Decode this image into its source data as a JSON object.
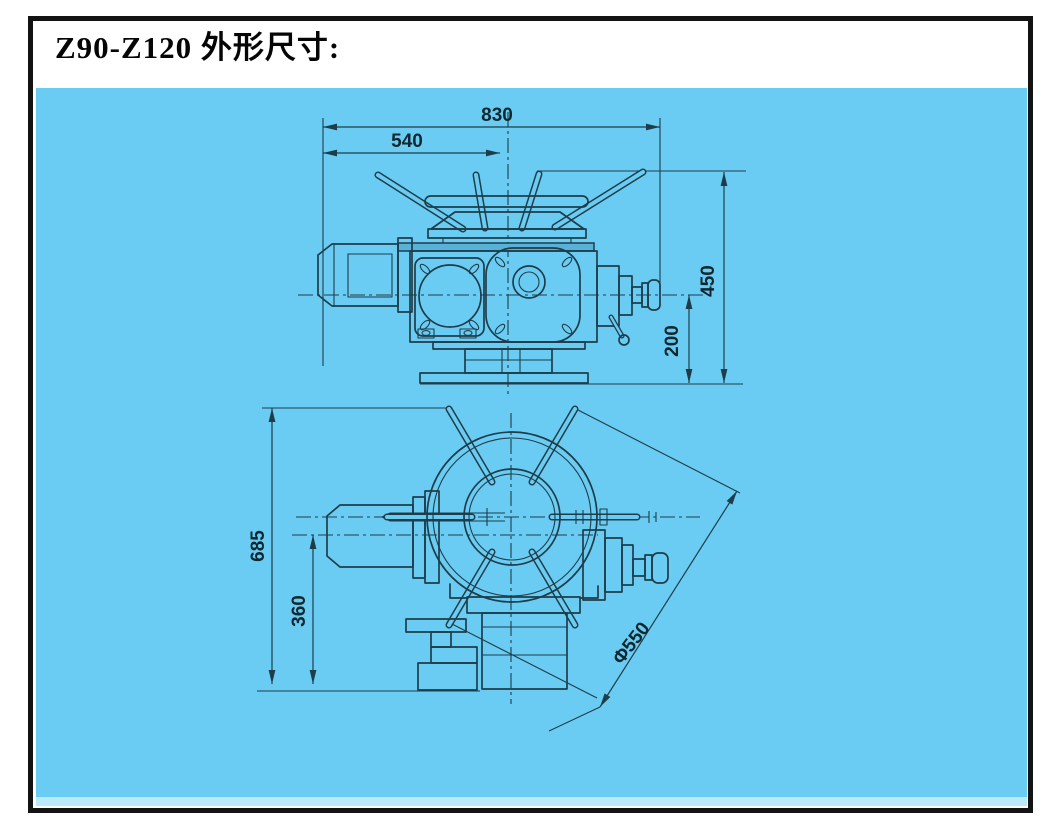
{
  "title": "Z90-Z120 外形尺寸:",
  "colors": {
    "panel_blue": "#6accf2",
    "panel_edge": "#bce9fa",
    "line": "#1e3d4a",
    "text": "#0f2830",
    "frame": "#131313",
    "shade": "#58b2d8"
  },
  "front_view": {
    "dims": {
      "total_width": "830",
      "width_to_axis": "540",
      "total_height": "450",
      "axis_to_base": "200"
    }
  },
  "top_view": {
    "dims": {
      "total_length": "685",
      "motor_axis_to_base": "360",
      "handwheel_diameter": "Φ550"
    }
  }
}
